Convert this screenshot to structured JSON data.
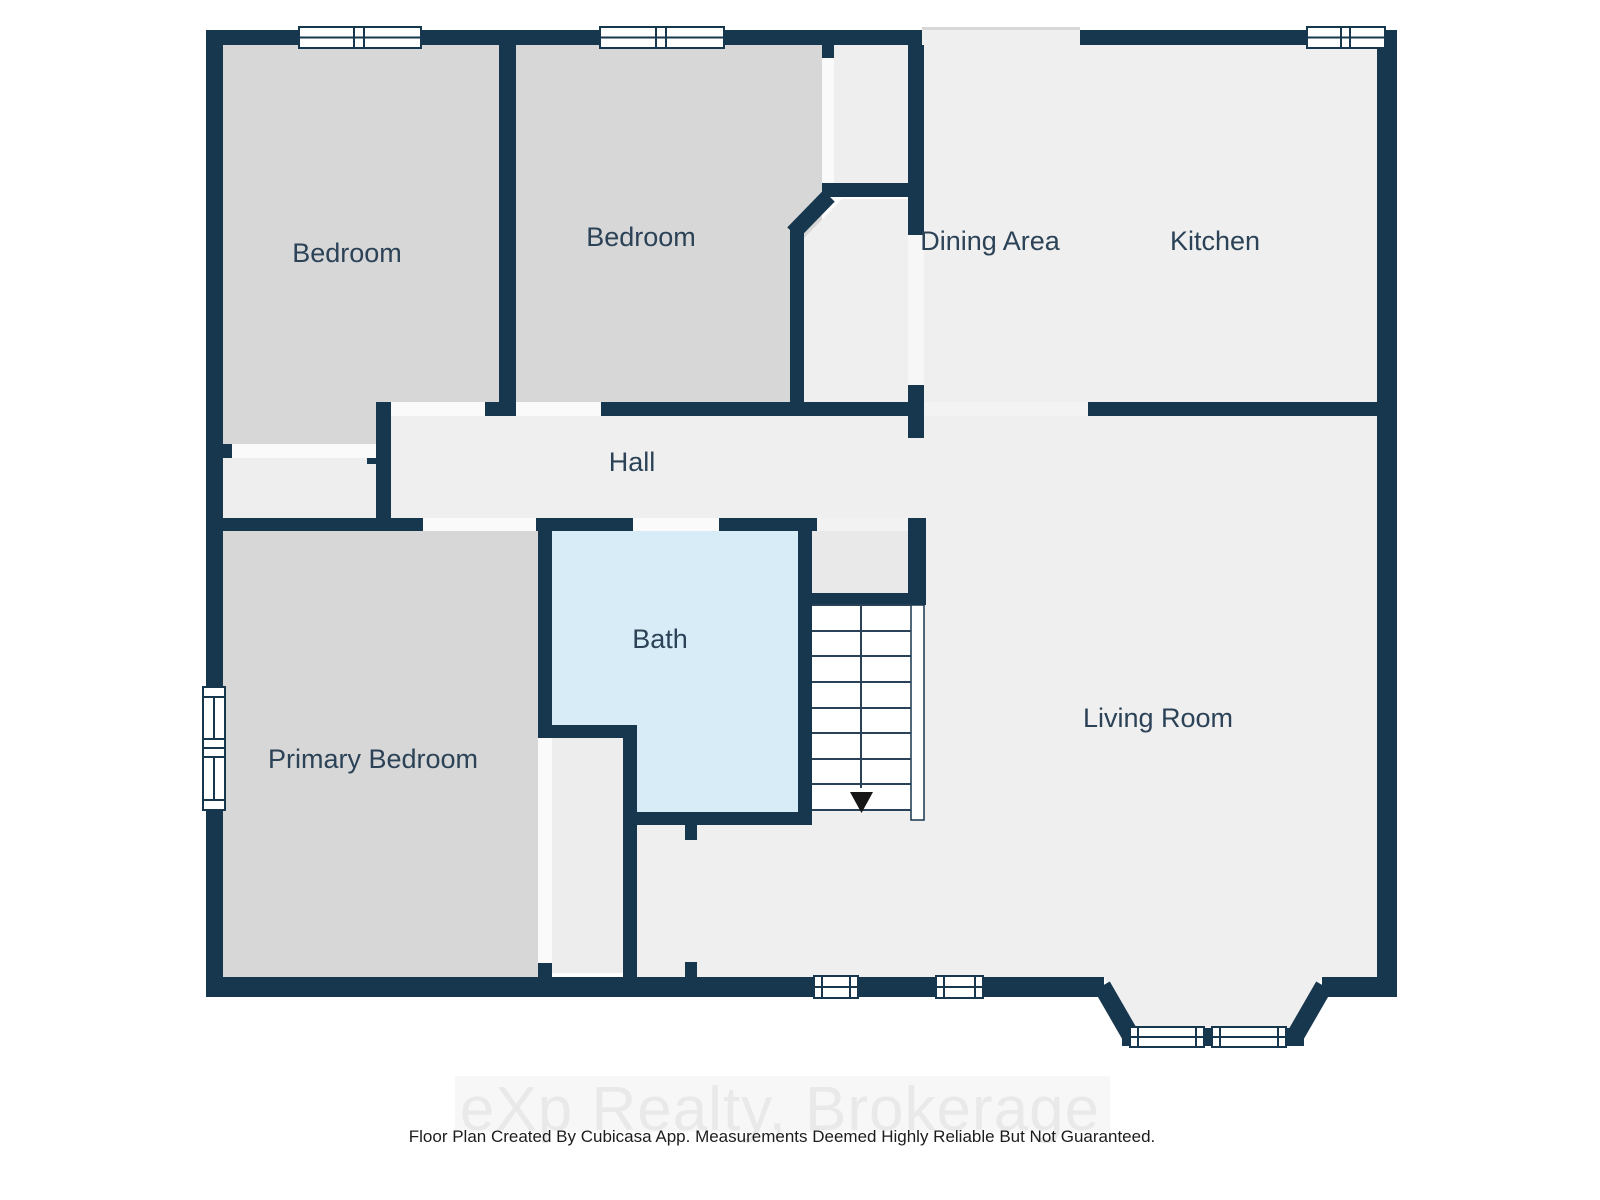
{
  "floorplan": {
    "wall_color": "#17374e",
    "floor_color": "#efefef",
    "bedroom_fill": "#d7d7d7",
    "bath_fill": "#d8ecf8",
    "label_color": "#2b4257",
    "rooms": [
      {
        "id": "bedroom-1",
        "label": "Bedroom"
      },
      {
        "id": "bedroom-2",
        "label": "Bedroom"
      },
      {
        "id": "dining-area",
        "label": "Dining Area"
      },
      {
        "id": "kitchen",
        "label": "Kitchen"
      },
      {
        "id": "hall",
        "label": "Hall"
      },
      {
        "id": "bath",
        "label": "Bath"
      },
      {
        "id": "primary-bedroom",
        "label": "Primary Bedroom"
      },
      {
        "id": "living-room",
        "label": "Living Room"
      }
    ],
    "stairs": {
      "steps": 8,
      "direction": "down"
    },
    "window_count": 8
  },
  "watermark": {
    "text": "eXp Realty, Brokerage",
    "color": "#e9e9e9"
  },
  "footer": {
    "text": "Floor Plan Created By Cubicasa App. Measurements Deemed Highly Reliable But Not Guaranteed.",
    "color": "#1c1c1c"
  }
}
